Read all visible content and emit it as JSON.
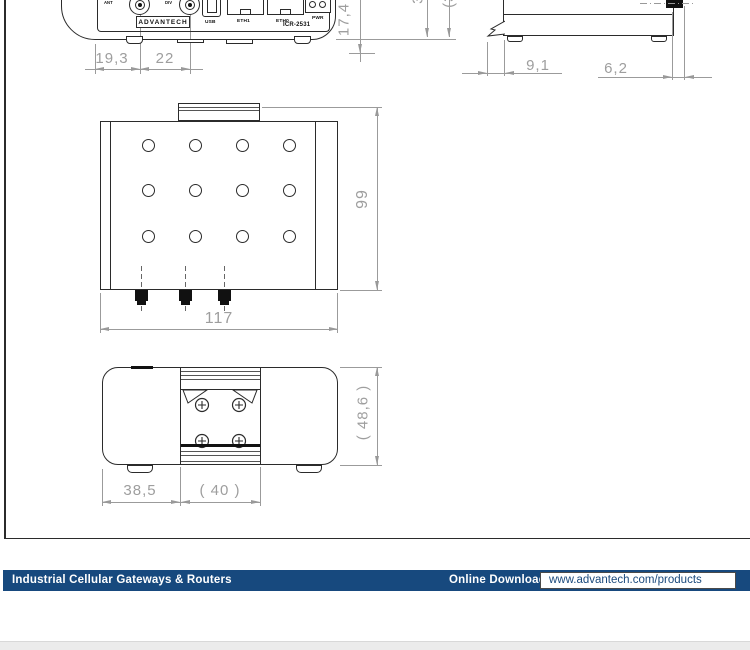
{
  "colors": {
    "outline": "#2b2b2b",
    "dimension": "#9e9e9e",
    "footer_bar": "#17497e",
    "footer_url_text": "#1b4a7d"
  },
  "front_view": {
    "labels": {
      "ant": "ANT",
      "div": "DIV",
      "usb": "USB",
      "eth1": "ETH1",
      "eth0": "ETH0",
      "pwr": "PWR"
    },
    "brand": "ADVANTECH",
    "model": "ICR-2531",
    "dims": {
      "d1": "19,3",
      "d2": "22",
      "height": "17,4"
    }
  },
  "side_view": {
    "dims": {
      "clip": "9,1",
      "antenna": "6,2",
      "cut_fragment_a": "30",
      "cut_fragment_b": "(35)"
    }
  },
  "top_view": {
    "dims": {
      "width": "117",
      "depth": "99"
    }
  },
  "bottom_view": {
    "dims": {
      "left": "38,5",
      "din_clip": "( 40 )",
      "height": "( 48,6 )"
    }
  },
  "footer": {
    "category": "Industrial Cellular Gateways & Routers",
    "download_label": "Online Download",
    "url": "www.advantech.com/products"
  }
}
